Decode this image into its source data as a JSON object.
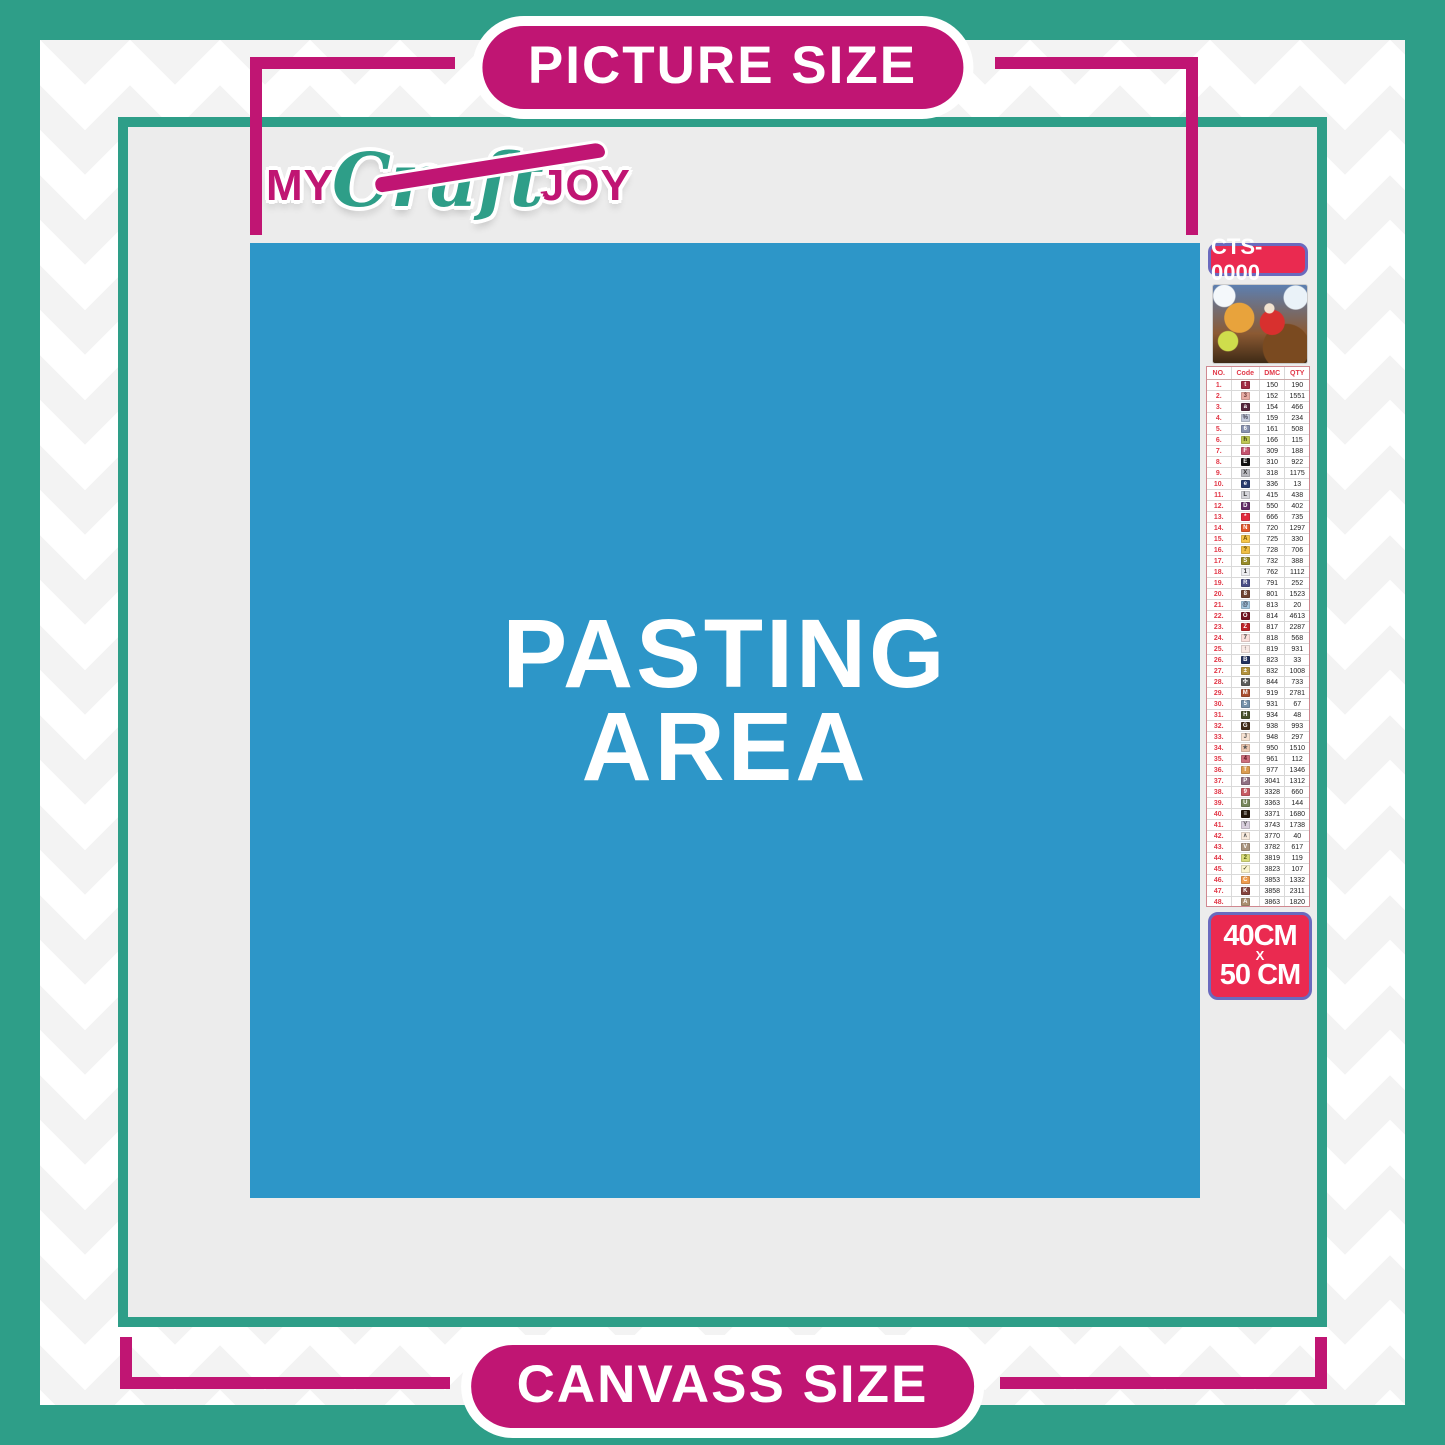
{
  "header": {
    "picture_size_label": "PICTURE SIZE"
  },
  "footer": {
    "canvass_size_label": "CANVASS SIZE"
  },
  "logo": {
    "my": "MY",
    "craft": "Craft",
    "joy": "JOY"
  },
  "pasting_area": {
    "line1": "PASTING",
    "line2": "AREA"
  },
  "kit": {
    "sku": "CTS-0000",
    "thumbnail_name": "christmas-santa-sleigh-artwork",
    "size": {
      "width_label": "40CM",
      "x_label": "X",
      "height_label": "50 CM"
    }
  },
  "colors": {
    "teal": "#2E9E88",
    "magenta": "#C01573",
    "pasting_blue": "#2D96C8",
    "canvas_gray": "#ECECEC",
    "badge_red": "#EA2A50",
    "badge_border": "#6A6ABE",
    "table_accent_red": "#E23848"
  },
  "legend": {
    "columns": [
      "NO.",
      "Code",
      "DMC",
      "QTY"
    ],
    "rows": [
      {
        "no": "1.",
        "symbol": "t",
        "chip": "#A12C44",
        "symbol_color": "#ffffff",
        "dmc": "150",
        "qty": "190"
      },
      {
        "no": "2.",
        "symbol": "3",
        "chip": "#E8ACA4",
        "symbol_color": "#6b3a3a",
        "dmc": "152",
        "qty": "1551"
      },
      {
        "no": "3.",
        "symbol": "a",
        "chip": "#57283E",
        "symbol_color": "#ffffff",
        "dmc": "154",
        "qty": "466"
      },
      {
        "no": "4.",
        "symbol": "%",
        "chip": "#C4CADB",
        "symbol_color": "#444455",
        "dmc": "159",
        "qty": "234"
      },
      {
        "no": "5.",
        "symbol": "6",
        "chip": "#8A93B0",
        "symbol_color": "#ffffff",
        "dmc": "161",
        "qty": "508"
      },
      {
        "no": "6.",
        "symbol": "h",
        "chip": "#BEC755",
        "symbol_color": "#333311",
        "dmc": "166",
        "qty": "115"
      },
      {
        "no": "7.",
        "symbol": "F",
        "chip": "#C4536F",
        "symbol_color": "#ffffff",
        "dmc": "309",
        "qty": "188"
      },
      {
        "no": "8.",
        "symbol": "E",
        "chip": "#121212",
        "symbol_color": "#ffffff",
        "dmc": "310",
        "qty": "922"
      },
      {
        "no": "9.",
        "symbol": "X",
        "chip": "#B9B9BE",
        "symbol_color": "#333333",
        "dmc": "318",
        "qty": "1175"
      },
      {
        "no": "10.",
        "symbol": "e",
        "chip": "#2A3C6E",
        "symbol_color": "#ffffff",
        "dmc": "336",
        "qty": "13"
      },
      {
        "no": "11.",
        "symbol": "L",
        "chip": "#D5D5DA",
        "symbol_color": "#333333",
        "dmc": "415",
        "qty": "438"
      },
      {
        "no": "12.",
        "symbol": "D",
        "chip": "#632C67",
        "symbol_color": "#ffffff",
        "dmc": "550",
        "qty": "402"
      },
      {
        "no": "13.",
        "symbol": "*",
        "chip": "#E12A3C",
        "symbol_color": "#ffffff",
        "dmc": "666",
        "qty": "735"
      },
      {
        "no": "14.",
        "symbol": "N",
        "chip": "#E2582B",
        "symbol_color": "#ffffff",
        "dmc": "720",
        "qty": "1297"
      },
      {
        "no": "15.",
        "symbol": "A",
        "chip": "#F6C64A",
        "symbol_color": "#6b4a00",
        "dmc": "725",
        "qty": "330"
      },
      {
        "no": "16.",
        "symbol": "?",
        "chip": "#EFBF45",
        "symbol_color": "#5a4300",
        "dmc": "728",
        "qty": "706"
      },
      {
        "no": "17.",
        "symbol": "S",
        "chip": "#988C2A",
        "symbol_color": "#ffffff",
        "dmc": "732",
        "qty": "388"
      },
      {
        "no": "18.",
        "symbol": "1",
        "chip": "#EDEDF0",
        "symbol_color": "#333333",
        "dmc": "762",
        "qty": "1112"
      },
      {
        "no": "19.",
        "symbol": "R",
        "chip": "#4B4F87",
        "symbol_color": "#ffffff",
        "dmc": "791",
        "qty": "252"
      },
      {
        "no": "20.",
        "symbol": "8",
        "chip": "#6F4431",
        "symbol_color": "#ffffff",
        "dmc": "801",
        "qty": "1523"
      },
      {
        "no": "21.",
        "symbol": "@",
        "chip": "#A4C7DF",
        "symbol_color": "#333344",
        "dmc": "813",
        "qty": "20"
      },
      {
        "no": "22.",
        "symbol": "O",
        "chip": "#741624",
        "symbol_color": "#ffffff",
        "dmc": "814",
        "qty": "4613"
      },
      {
        "no": "23.",
        "symbol": "Z",
        "chip": "#BD2429",
        "symbol_color": "#ffffff",
        "dmc": "817",
        "qty": "2287"
      },
      {
        "no": "24.",
        "symbol": "7",
        "chip": "#FBE0DC",
        "symbol_color": "#444444",
        "dmc": "818",
        "qty": "568"
      },
      {
        "no": "25.",
        "symbol": "↑",
        "chip": "#F8E9E5",
        "symbol_color": "#444444",
        "dmc": "819",
        "qty": "931"
      },
      {
        "no": "26.",
        "symbol": "B",
        "chip": "#23325F",
        "symbol_color": "#ffffff",
        "dmc": "823",
        "qty": "33"
      },
      {
        "no": "27.",
        "symbol": "±",
        "chip": "#B3923C",
        "symbol_color": "#ffffff",
        "dmc": "832",
        "qty": "1008"
      },
      {
        "no": "28.",
        "symbol": "✣",
        "chip": "#5B5B59",
        "symbol_color": "#ffffff",
        "dmc": "844",
        "qty": "733"
      },
      {
        "no": "29.",
        "symbol": "M",
        "chip": "#A94F2F",
        "symbol_color": "#ffffff",
        "dmc": "919",
        "qty": "2781"
      },
      {
        "no": "30.",
        "symbol": "5",
        "chip": "#7591AA",
        "symbol_color": "#ffffff",
        "dmc": "931",
        "qty": "67"
      },
      {
        "no": "31.",
        "symbol": "H",
        "chip": "#47512C",
        "symbol_color": "#ffffff",
        "dmc": "934",
        "qty": "48"
      },
      {
        "no": "32.",
        "symbol": "G",
        "chip": "#442E19",
        "symbol_color": "#ffffff",
        "dmc": "938",
        "qty": "993"
      },
      {
        "no": "33.",
        "symbol": "J",
        "chip": "#F8E3D3",
        "symbol_color": "#555555",
        "dmc": "948",
        "qty": "297"
      },
      {
        "no": "34.",
        "symbol": "★",
        "chip": "#ECC7B0",
        "symbol_color": "#555555",
        "dmc": "950",
        "qty": "1510"
      },
      {
        "no": "35.",
        "symbol": "4",
        "chip": "#CD6F7D",
        "symbol_color": "#5a1420",
        "dmc": "961",
        "qty": "112"
      },
      {
        "no": "36.",
        "symbol": "T",
        "chip": "#DB9D52",
        "symbol_color": "#ffffff",
        "dmc": "977",
        "qty": "1346"
      },
      {
        "no": "37.",
        "symbol": "P",
        "chip": "#907083",
        "symbol_color": "#ffffff",
        "dmc": "3041",
        "qty": "1312"
      },
      {
        "no": "38.",
        "symbol": "9",
        "chip": "#C75B63",
        "symbol_color": "#ffffff",
        "dmc": "3328",
        "qty": "660"
      },
      {
        "no": "39.",
        "symbol": "U",
        "chip": "#78875D",
        "symbol_color": "#ffffff",
        "dmc": "3363",
        "qty": "144"
      },
      {
        "no": "40.",
        "symbol": "≡",
        "chip": "#22160A",
        "symbol_color": "#ffffff",
        "dmc": "3371",
        "qty": "1680"
      },
      {
        "no": "41.",
        "symbol": "Y",
        "chip": "#D9CFDD",
        "symbol_color": "#555555",
        "dmc": "3743",
        "qty": "1738"
      },
      {
        "no": "42.",
        "symbol": "∧",
        "chip": "#FAECDE",
        "symbol_color": "#555555",
        "dmc": "3770",
        "qty": "40"
      },
      {
        "no": "43.",
        "symbol": "V",
        "chip": "#A9947E",
        "symbol_color": "#ffffff",
        "dmc": "3782",
        "qty": "617"
      },
      {
        "no": "44.",
        "symbol": "2",
        "chip": "#D9DC7B",
        "symbol_color": "#556014",
        "dmc": "3819",
        "qty": "119"
      },
      {
        "no": "45.",
        "symbol": "✓",
        "chip": "#FBF5D0",
        "symbol_color": "#555533",
        "dmc": "3823",
        "qty": "107"
      },
      {
        "no": "46.",
        "symbol": "C",
        "chip": "#EF9C4E",
        "symbol_color": "#ffffff",
        "dmc": "3853",
        "qty": "1332"
      },
      {
        "no": "47.",
        "symbol": "K",
        "chip": "#85433D",
        "symbol_color": "#ffffff",
        "dmc": "3858",
        "qty": "2311"
      },
      {
        "no": "48.",
        "symbol": "A",
        "chip": "#AA8E70",
        "symbol_color": "#ffffff",
        "dmc": "3863",
        "qty": "1820"
      }
    ]
  }
}
